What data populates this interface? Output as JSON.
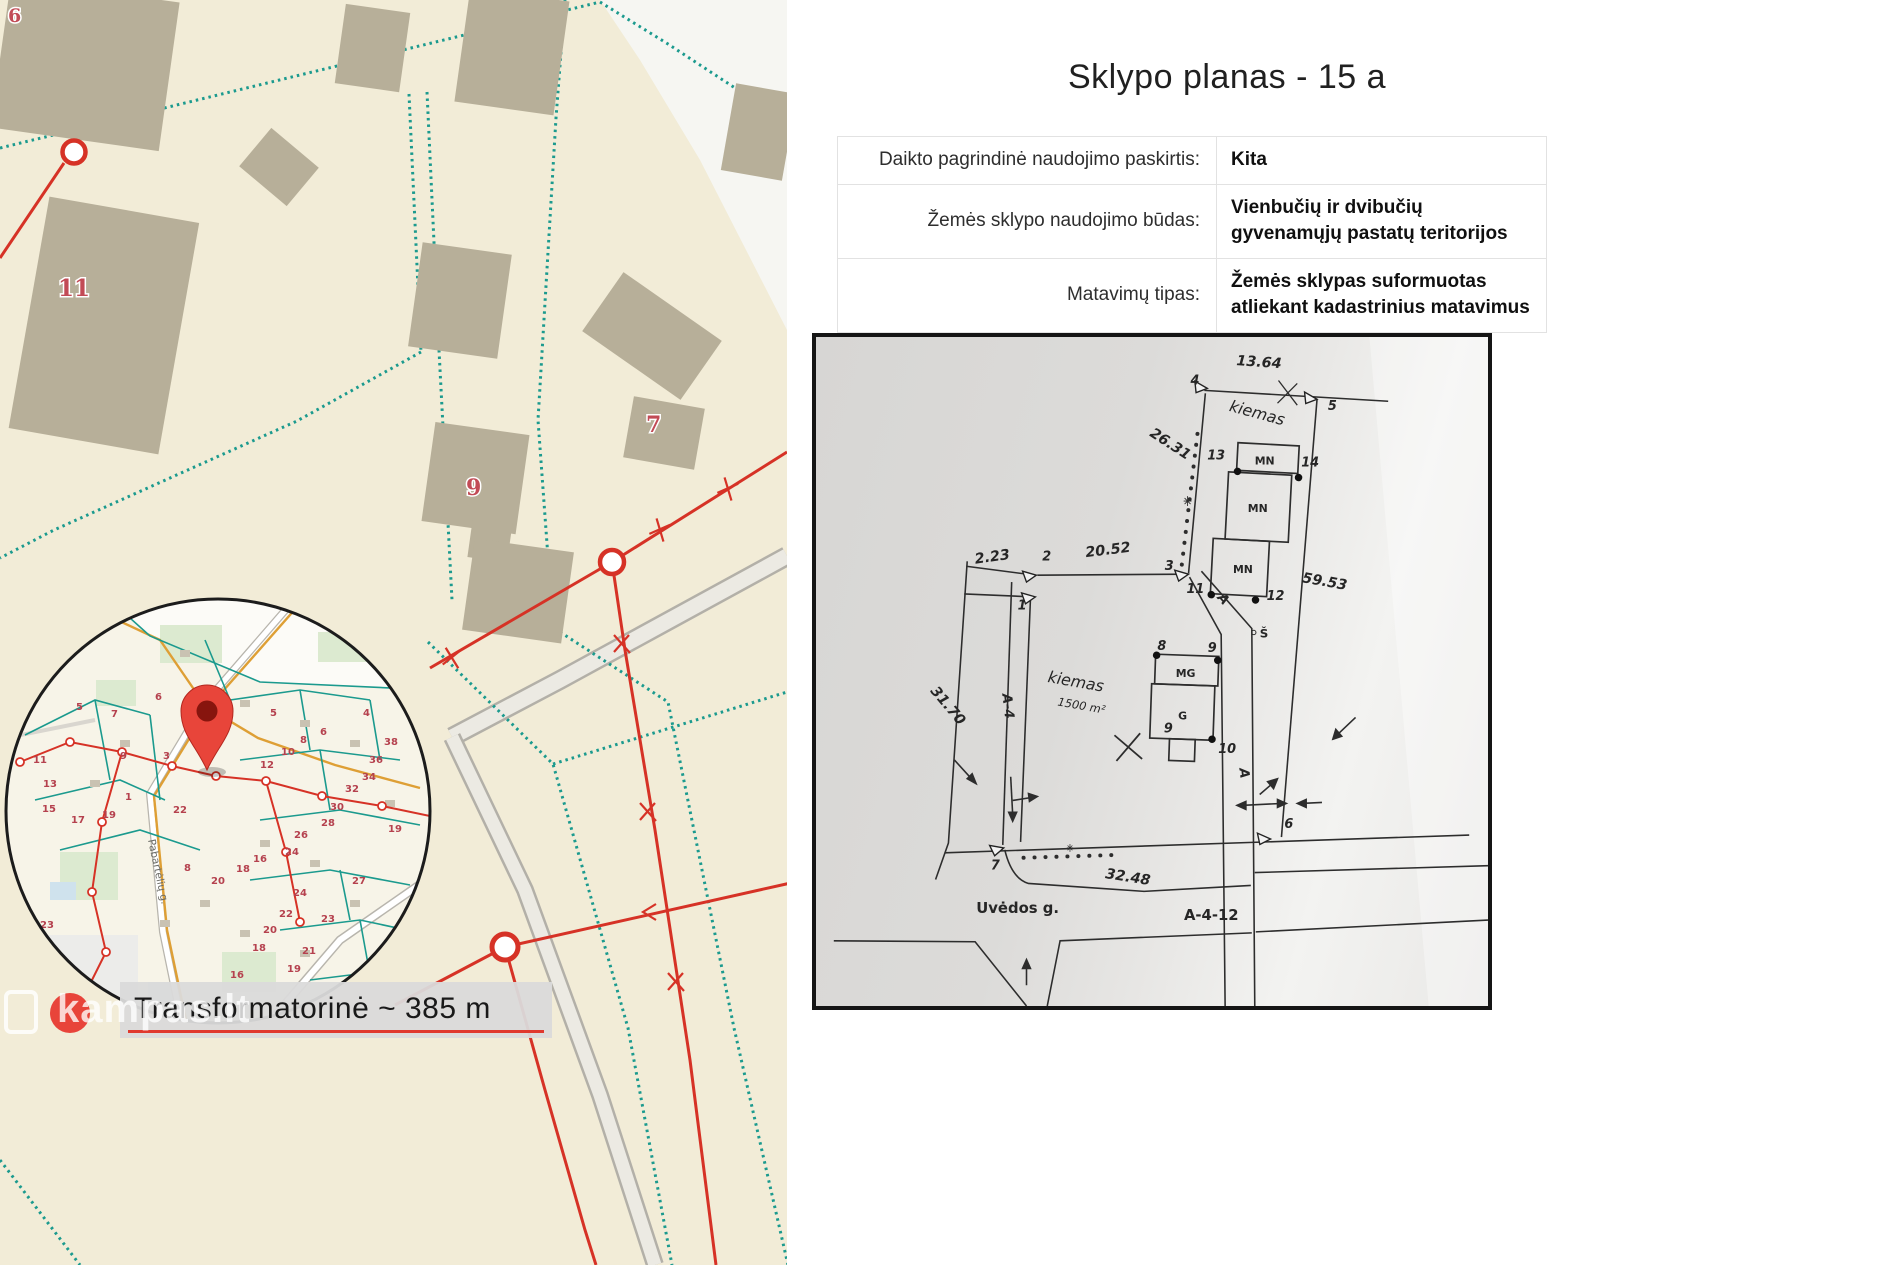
{
  "panel": {
    "title": "Sklypo planas - 15 a",
    "table": {
      "rows": [
        {
          "label": "Daikto pagrindinė naudojimo paskirtis:",
          "value": "Kita"
        },
        {
          "label": "Žemės sklypo naudojimo būdas:",
          "value": "Vienbučių ir dvibučių gyvenamųjų pastatų teritorijos"
        },
        {
          "label": "Matavimų tipas:",
          "value": "Žemės sklypas suformuotas atliekant kadastrinius matavimus"
        }
      ]
    }
  },
  "plan": {
    "dims": {
      "top": "13.64",
      "upper_left": "26.31",
      "mid": "20.52",
      "small": "2.23",
      "left": "31.70",
      "right": "59.53",
      "bottom": "32.48"
    },
    "points": {
      "p1": "1",
      "p2": "2",
      "p3": "3",
      "p4": "4",
      "p5": "5",
      "p6": "6",
      "p7": "7",
      "p8": "8",
      "p9": "9",
      "p9b": "9",
      "p10": "10",
      "p11": "11",
      "p12": "12",
      "p13": "13",
      "p14": "14"
    },
    "labels": {
      "mn_top": "MN",
      "mn_mid": "MN",
      "mn_low": "MN",
      "mg": "MG",
      "g": "G",
      "yard_top": "kiemas",
      "yard": "kiemas",
      "yard_area": "1500 m²",
      "road_a4": "A-4",
      "road_a_upper": "A",
      "road_a_lower": "A",
      "road_a412": "A-4-12",
      "street": "Uvėdos g.",
      "north": "Š"
    }
  },
  "map": {
    "numbers": {
      "n6": "6",
      "n11": "11",
      "n9": "9",
      "n7": "7"
    },
    "inset": {
      "street": "Pabartėlių g.",
      "label": "Transformatorinė ~ 385 m",
      "numbers": [
        {
          "t": "6",
          "x": 155,
          "y": 700
        },
        {
          "t": "7",
          "x": 111,
          "y": 717
        },
        {
          "t": "5",
          "x": 76,
          "y": 710
        },
        {
          "t": "11",
          "x": 33,
          "y": 763
        },
        {
          "t": "9",
          "x": 120,
          "y": 759
        },
        {
          "t": "3",
          "x": 163,
          "y": 759
        },
        {
          "t": "13",
          "x": 43,
          "y": 787
        },
        {
          "t": "15",
          "x": 42,
          "y": 812
        },
        {
          "t": "17",
          "x": 71,
          "y": 823
        },
        {
          "t": "19",
          "x": 102,
          "y": 818
        },
        {
          "t": "1",
          "x": 125,
          "y": 800
        },
        {
          "t": "22",
          "x": 173,
          "y": 813
        },
        {
          "t": "12",
          "x": 260,
          "y": 768
        },
        {
          "t": "5",
          "x": 270,
          "y": 716
        },
        {
          "t": "10",
          "x": 281,
          "y": 755
        },
        {
          "t": "8",
          "x": 300,
          "y": 743
        },
        {
          "t": "6",
          "x": 320,
          "y": 735
        },
        {
          "t": "4",
          "x": 363,
          "y": 716
        },
        {
          "t": "2",
          "x": 394,
          "y": 696
        },
        {
          "t": "38",
          "x": 384,
          "y": 745
        },
        {
          "t": "36",
          "x": 369,
          "y": 763
        },
        {
          "t": "34",
          "x": 362,
          "y": 780
        },
        {
          "t": "32",
          "x": 345,
          "y": 792
        },
        {
          "t": "30",
          "x": 330,
          "y": 810
        },
        {
          "t": "28",
          "x": 321,
          "y": 826
        },
        {
          "t": "26",
          "x": 294,
          "y": 838
        },
        {
          "t": "16",
          "x": 253,
          "y": 862
        },
        {
          "t": "18",
          "x": 236,
          "y": 872
        },
        {
          "t": "8",
          "x": 184,
          "y": 871
        },
        {
          "t": "20",
          "x": 211,
          "y": 884
        },
        {
          "t": "24",
          "x": 293,
          "y": 896
        },
        {
          "t": "22",
          "x": 279,
          "y": 917
        },
        {
          "t": "23",
          "x": 321,
          "y": 922
        },
        {
          "t": "20",
          "x": 263,
          "y": 933
        },
        {
          "t": "18",
          "x": 252,
          "y": 951
        },
        {
          "t": "21",
          "x": 302,
          "y": 954
        },
        {
          "t": "19",
          "x": 287,
          "y": 972
        },
        {
          "t": "16",
          "x": 230,
          "y": 978
        },
        {
          "t": "23",
          "x": 40,
          "y": 928
        },
        {
          "t": "27",
          "x": 352,
          "y": 884
        },
        {
          "t": "19",
          "x": 388,
          "y": 832
        },
        {
          "t": "24",
          "x": 285,
          "y": 855
        }
      ]
    },
    "watermark": "kampas.lt"
  },
  "colors": {
    "teal": "#1b9a8e",
    "red": "#d63226",
    "map_bg": "#f2ecd7",
    "building": "#b7af99",
    "accent_red": "#e0392e"
  }
}
